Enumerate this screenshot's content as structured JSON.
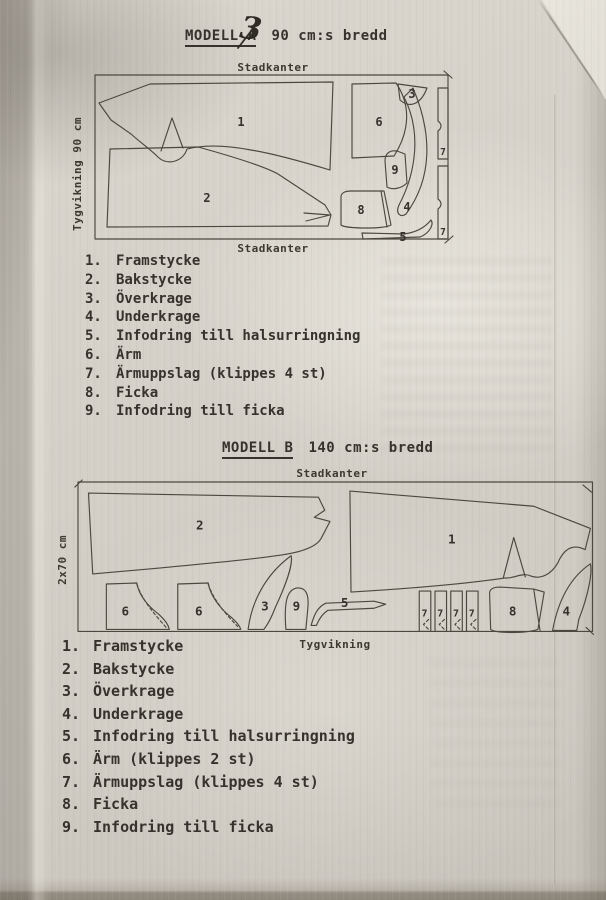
{
  "photo": {
    "paper_color": "#d4d0c8",
    "ink_color": "#36332c",
    "line_color": "#4c483f"
  },
  "model_a": {
    "title": "MODELL A",
    "handwritten_note": "3",
    "width_label": "90 cm:s bredd",
    "diagram": {
      "top_edge": "Stadkanter",
      "bottom_edge": "Stadkanter",
      "fold_edge": "Tygvikning 90 cm",
      "pieces": {
        "n1": "1",
        "n2": "2",
        "n3": "3",
        "n4": "4",
        "n5": "5",
        "n6": "6",
        "n7a": "7",
        "n7b": "7",
        "n8": "8",
        "n9": "9"
      }
    },
    "legend": [
      {
        "num": "1.",
        "label": "Framstycke"
      },
      {
        "num": "2.",
        "label": "Bakstycke"
      },
      {
        "num": "3.",
        "label": "Överkrage"
      },
      {
        "num": "4.",
        "label": "Underkrage"
      },
      {
        "num": "5.",
        "label": "Infodring till halsurringning"
      },
      {
        "num": "6.",
        "label": "Ärm"
      },
      {
        "num": "7.",
        "label": "Ärmuppslag (klippes 4 st)"
      },
      {
        "num": "8.",
        "label": "Ficka"
      },
      {
        "num": "9.",
        "label": "Infodring till ficka"
      }
    ]
  },
  "model_b": {
    "title": "MODELL B",
    "width_label": "140 cm:s bredd",
    "diagram": {
      "top_edge": "Stadkanter",
      "bottom_edge": "Tygvikning",
      "fold_edge": "2x70 cm",
      "pieces": {
        "n1": "1",
        "n2": "2",
        "n3": "3",
        "n4": "4",
        "n5": "5",
        "n6a": "6",
        "n6b": "6",
        "n7a": "7",
        "n7b": "7",
        "n7c": "7",
        "n7d": "7",
        "n8": "8",
        "n9": "9"
      }
    },
    "legend": [
      {
        "num": "1.",
        "label": "Framstycke"
      },
      {
        "num": "2.",
        "label": "Bakstycke"
      },
      {
        "num": "3.",
        "label": "Överkrage"
      },
      {
        "num": "4.",
        "label": "Underkrage"
      },
      {
        "num": "5.",
        "label": "Infodring till halsurringning"
      },
      {
        "num": "6.",
        "label": "Ärm (klippes 2 st)"
      },
      {
        "num": "7.",
        "label": "Ärmuppslag (klippes 4 st)"
      },
      {
        "num": "8.",
        "label": "Ficka"
      },
      {
        "num": "9.",
        "label": "Infodring till ficka"
      }
    ]
  }
}
